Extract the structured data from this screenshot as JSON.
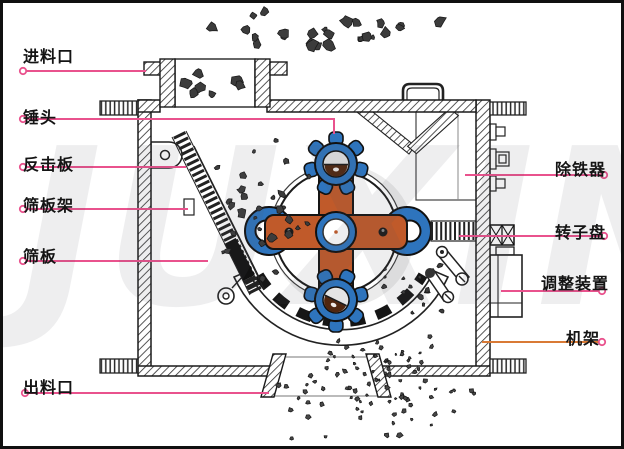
{
  "watermark": "JUXIN",
  "labels": {
    "feed_inlet": "进料口",
    "hammer_head": "锤头",
    "impact_plate": "反击板",
    "screen_frame": "筛板架",
    "screen_plate": "筛板",
    "discharge_outlet": "出料口",
    "iron_remover": "除铁器",
    "rotor_disc": "转子盘",
    "adjustment_device": "调整装置",
    "frame": "机架"
  },
  "colors": {
    "leader_pink": "#e9528d",
    "leader_orange": "#d97a35",
    "rotor_arm_orange": "#c05a2a",
    "hammer_blue": "#2e74bd",
    "hammer_core_brown": "#50260f",
    "line_black": "#1a1a1a",
    "rock_gray": "#3c3c3c"
  },
  "particle_clusters": [
    {
      "name": "rocks-top-spray",
      "x": 175,
      "y": 6,
      "w": 272,
      "h": 54,
      "count": 26,
      "min_r": 2.5,
      "max_r": 6.5,
      "style": "rock"
    },
    {
      "name": "rocks-in-hopper",
      "x": 176,
      "y": 62,
      "w": 74,
      "h": 36,
      "count": 8,
      "min_r": 3.0,
      "max_r": 6.5,
      "style": "rock"
    },
    {
      "name": "rocks-impact-path",
      "x": 200,
      "y": 112,
      "w": 116,
      "h": 198,
      "count": 30,
      "min_r": 1.8,
      "max_r": 4.8,
      "style": "rock"
    },
    {
      "name": "rocks-screen-right",
      "x": 350,
      "y": 248,
      "w": 112,
      "h": 72,
      "count": 14,
      "min_r": 1.5,
      "max_r": 3.2,
      "style": "rock"
    },
    {
      "name": "fines-discharge-spray",
      "x": 268,
      "y": 330,
      "w": 210,
      "h": 112,
      "count": 92,
      "min_r": 1.2,
      "max_r": 2.8,
      "style": "fine"
    }
  ]
}
